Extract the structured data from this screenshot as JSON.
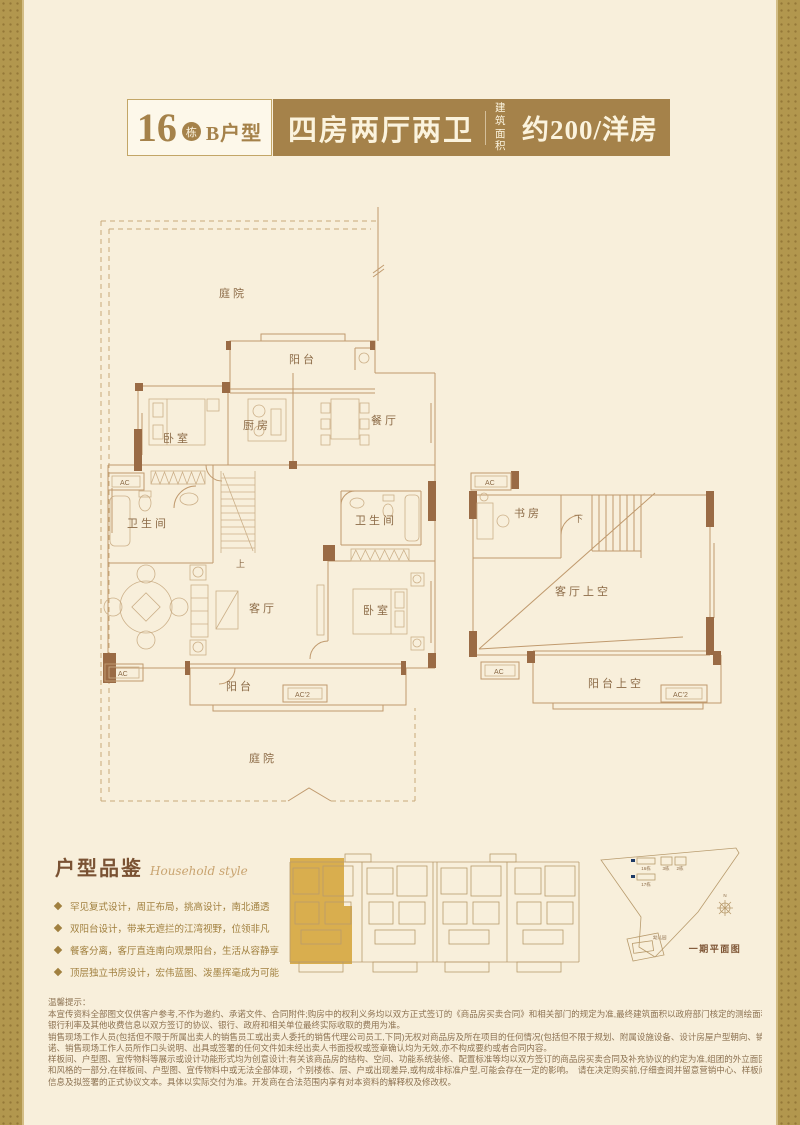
{
  "header": {
    "block_number": "16",
    "block_suffix": "栋",
    "unit_name": "B户型",
    "layout_title": "四房两厅两卫",
    "area_label_top": "建筑",
    "area_label_bottom": "面积",
    "area_value": "约200/洋房"
  },
  "floorplan": {
    "courtyard": "庭院",
    "balcony": "阳台",
    "kitchen": "厨房",
    "dining": "餐厅",
    "bedroom": "卧室",
    "bathroom": "卫生间",
    "living": "客厅",
    "study": "书房",
    "living_void": "客厅上空",
    "balcony_void": "阳台上空",
    "stairs_up": "上",
    "stairs_down": "下",
    "ac": "AC",
    "ac2": "AC'2"
  },
  "features": {
    "heading": "户型品鉴",
    "heading_script": "Household style",
    "items": [
      "罕见复式设计，周正布局，挑高设计，南北通透",
      "双阳台设计，带来无遮拦的江湾视野，位领非凡",
      "餐客分离，客厅直连南向观景阳台，生活从容静享",
      "顶层独立书房设计，宏伟蓝图、泼墨挥毫成为可能"
    ]
  },
  "siteplan": {
    "caption": "一期平面图",
    "b16": "16栋",
    "b17": "17栋",
    "b3": "3栋",
    "b2": "2栋",
    "kindergarten": "幼儿园",
    "north": "N"
  },
  "disclaimer": {
    "title": "温馨提示：",
    "lines": [
      "本宣传资料全部图文仅供客户参考,不作为邀约、承诺文件、合同附件;购房中的权利义务均以双方正式签订的《商品房买卖合同》和相关部门的规定为准,最终建筑面积以政府部门核定的测绘面积为准,最终销售价格、",
      "银行利率及其他收费信息以双方签订的协议、银行、政府和相关单位最终实际收取的费用为准。",
      "销售现场工作人员(包括但不限于所属出卖人的销售员工或出卖人委托的销售代理公司员工,下同)无权对商品房及所在项目的任何情况(包括但不限于规划、附属设施设备、设计房屋户型朝向、销售优惠政策等)作出承",
      "诺、销售现场工作人员所作口头说明、出具或签署的任何文件如未经出卖人书面授权或签章确认均为无效,亦不构成要约或者合同内容。",
      "样板间、户型图、宣传物料等展示或设计功能形式均为创意设计;有关该商品房的结构、空间、功能系统装修、配置标准等均以双方签订的商品房买卖合同及补充协议的约定为准,组团的外立面因素构成了楼盘整体品质",
      "和风格的一部分,在样板间、户型图、宣传物料中或无法全部体现，个别楼栋、层、户或出现差异,或构成非标准户型,可能会存在一定的影响。　请在决定购买前,仔细查阅并留意营销中心、样板间的提示信息、政府批准",
      "信息及拟签署的正式协议文本。具体以实际交付为准。开发商在合法范围内享有对本资料的解释权及修改权。"
    ]
  },
  "colors": {
    "banner_gold": "#a5824a",
    "page_bg": "#f8efdb",
    "side_band": "#b2974e",
    "plan_line": "#c09a6e",
    "wall": "#9a6b45",
    "keyplan_highlight": "#d9ae4e",
    "marker_navy": "#1e3a66"
  }
}
